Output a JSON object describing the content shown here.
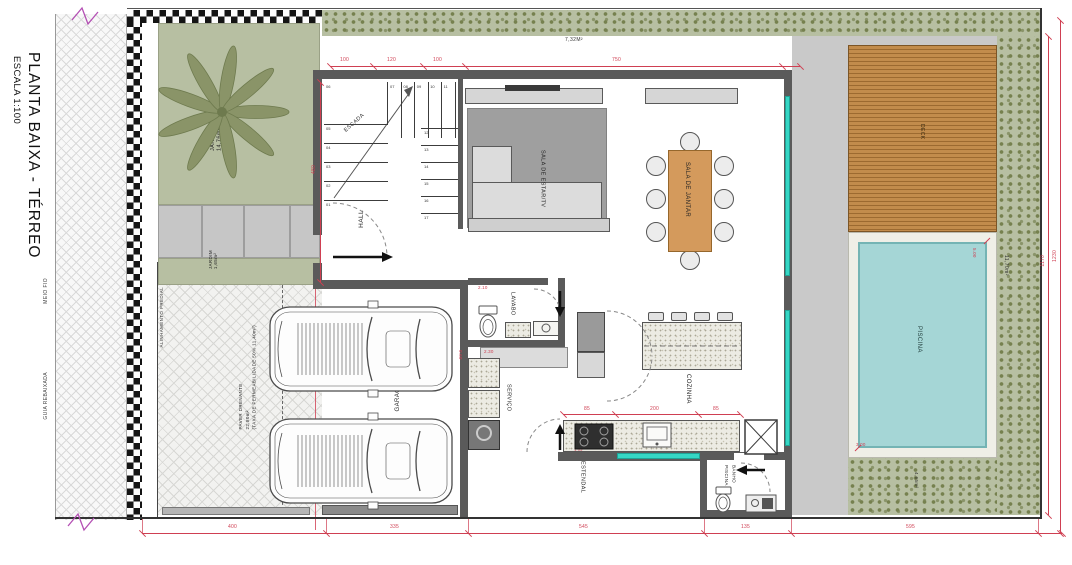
{
  "title": {
    "main": "PLANTA BAIXA - TÉRREO",
    "scale": "ESCALA 1:100"
  },
  "site": {
    "curb": "MEIO FIO",
    "lowered_curb": "GUIA REBAIXADA",
    "alignment": "ALINHAMENTO PREDIAL",
    "top_area": "7,32M²",
    "right_area": "11,70m²",
    "back_area": "4,65m²"
  },
  "garden": {
    "front": "JARDIM\n14,76m²",
    "small": "JARDIM\n1,65m²"
  },
  "paver": {
    "label": "PAVER DRENANTE\n22,80m²\n(TAXA DE PERMEABILIDADE 50% 11,40m²)"
  },
  "rooms": {
    "stairs": "ESCADA",
    "hall": "HALL",
    "living": "SALA DE ESTAR/TV",
    "dining": "SALA DE JANTAR",
    "kitchen": "COZINHA",
    "lavabo": "LAVABO",
    "service": "SERVIÇO",
    "drying": "ESTENDAL",
    "pool_bath": "BANHO\nPISCINA",
    "garage": "GARAGEM",
    "deck": "DECK",
    "pool": "PISCINA"
  },
  "stairs_steps": [
    "01",
    "02",
    "03",
    "04",
    "05",
    "06",
    "07",
    "08",
    "09",
    "10",
    "11",
    "12",
    "13",
    "14",
    "15",
    "16",
    "17"
  ],
  "dims": {
    "top": [
      "100",
      "120",
      "100",
      "750"
    ],
    "bottom": [
      "400",
      "335",
      "545",
      "135",
      "595"
    ],
    "counter": [
      "85",
      "200",
      "85"
    ],
    "right_inner": "1170",
    "right_outer": "1230",
    "left": "480",
    "lavabo": "2.10",
    "bench_w": "2.30",
    "bench_d": "0.60",
    "pool_w": "3.00",
    "pool_l": "5.00",
    "cooktop": "1.05"
  },
  "colors": {
    "dimension": "#cf3f52",
    "grass": "#b7bfa2",
    "wall": "#5a5a5a",
    "deck": "#c28c4c",
    "pool_water": "#a5d6d6",
    "window": "#35d6c4",
    "table": "#d49a5c",
    "break_mark": "#b44fb4"
  }
}
